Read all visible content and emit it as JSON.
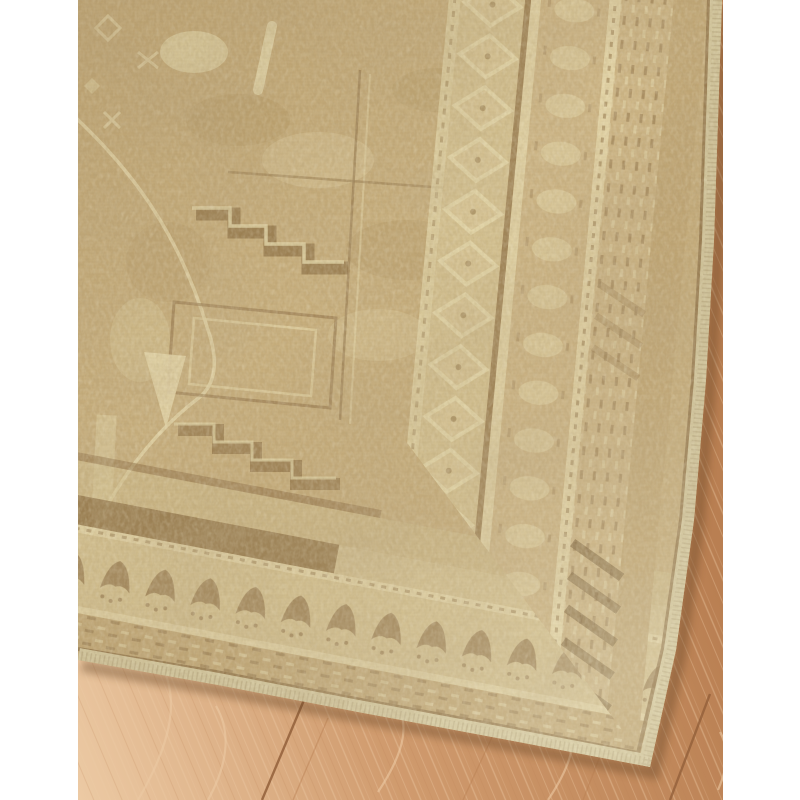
{
  "scene": {
    "type": "product-photograph",
    "subject": "Corner of a vintage-style distressed tan and beige tribal area rug laid diagonally on a light white-oak plank floor against a white studio background",
    "rug": {
      "style": "faded traditional / tribal geometric",
      "field_motifs": "arch outline, stepped greek-key lines, nested rectangle frames, abrash mottling",
      "border": "multiple parallel guard stripes and bands with tick, rosette-scallop, pale diamond and blotch motifs",
      "edge_finish": "cream serged binding",
      "corner_position": "bottom-right"
    },
    "floor": {
      "material": "white-oak hardwood planks",
      "visible_plank_seams": 2,
      "grain_direction": "diagonal, leaning left"
    },
    "background": "white"
  },
  "palette": {
    "page_bg": "#ffffff",
    "wood_base": "#d09b6e",
    "wood_light": "#eccaa4",
    "wood_shade": "#b97f52",
    "wood_seam": "#925f3a",
    "rug_field": "#c7ae7c",
    "rug_field_dark": "#a78b58",
    "rug_brown": "#8a6c42",
    "rug_brown_deep": "#6f5430",
    "rug_cream": "#e7dbae",
    "rug_cream_soft": "#d9cc9c",
    "band_tan": "#c2a876",
    "band_tan_light": "#cdb585",
    "band_pale": "#d4c190",
    "binding": "#d7cca2",
    "shadow": "#5f3f20"
  },
  "geometry": {
    "photo": {
      "left_px": 78,
      "top_px": 0,
      "width_px": 645,
      "height_px": 800
    },
    "rug_outline_points": "0,0 644,0 640,120 636,240 628,380 616,520 598,650 572,767 430,740 280,712 140,685 0,660",
    "edge_path": "M 644,0 L 640,120 636,240 628,380 616,520 598,650 572,767 L 430,740 280,712 140,685 0,660",
    "inner_seam_path": "M 631,0 L 627,120 623,240 615,380 603,520 585,648 560,753 L 428,727 278,699 138,672 0,649",
    "corner_clip_points": "-3,-100 -3,0 572,767 872,1167 1400,1167 1400,-100",
    "right_border_transform": "matrix(-0.0935,0.996,-0.996,-0.0935,644,0)",
    "bottom_border_transform": "matrix(0.9828,0.1873,0.1873,-0.9828,0,660)",
    "floor_seam_1": "M 226,700 L 184,800",
    "floor_seam_2": "M 632,694 L 592,800",
    "field_arch_path": "M -8,575 C 30,500 60,445 118,400 C 138,386 141,362 130,330 C 104,243 62,178 -2,118"
  }
}
